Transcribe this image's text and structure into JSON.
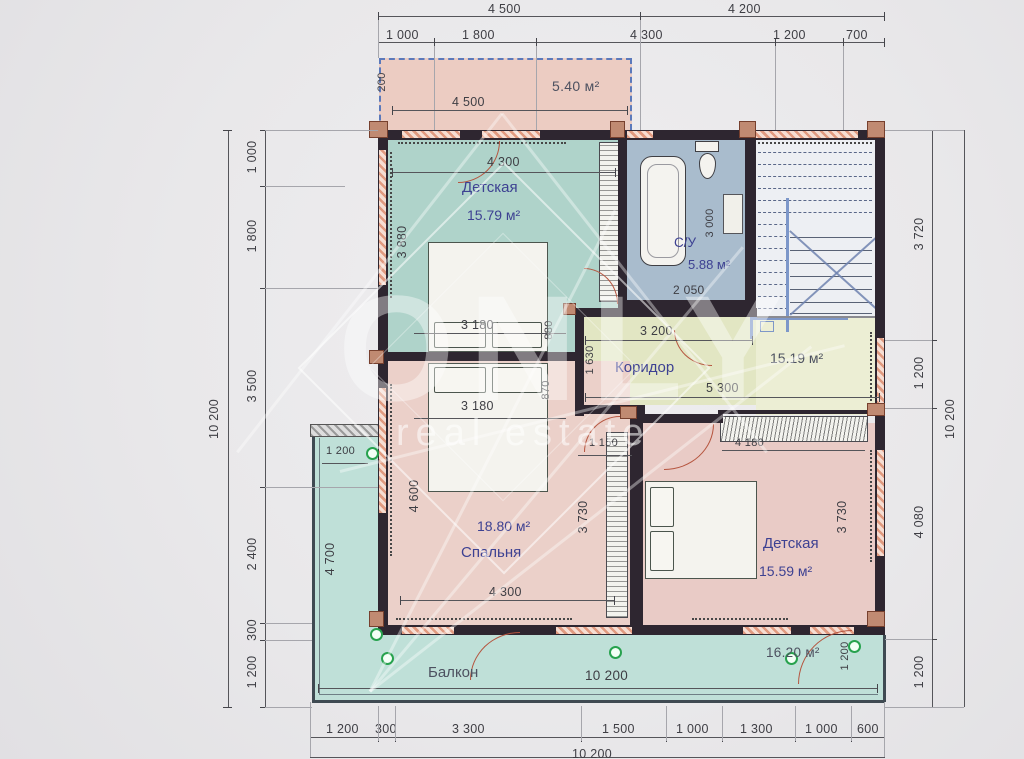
{
  "watermark": {
    "brand": "ONLY",
    "sub": "real estate"
  },
  "colors": {
    "room_teal": "#afd3ca",
    "room_pink": "#ebd0c9",
    "bath_blue": "#a9bccd",
    "corridor_green": "#e2e6c3",
    "hall_yellow": "#eceed4",
    "balcony_teal": "#bfe0d8",
    "balcony_top_pink": "#ecccc2",
    "wall": "#2e2630",
    "room_text": "#3d4192"
  },
  "dims": {
    "top1": [
      "4 500",
      "4 200"
    ],
    "top2": [
      "1 000",
      "1 800",
      "4 300",
      "1 200",
      "700"
    ],
    "left_total": "10 200",
    "left": [
      "1 000",
      "1 800",
      "3 500",
      "2 400",
      "300",
      "1 200"
    ],
    "right": [
      "3 720",
      "1 200",
      "4 080",
      "1 200"
    ],
    "right_total": "10 200",
    "bottom": [
      "1 200",
      "300",
      "3 300",
      "1 500",
      "1 000",
      "1 300",
      "1 000",
      "600"
    ],
    "bottom_total": "10 200"
  },
  "rooms": {
    "balcony_top": {
      "area": "5.40 м²",
      "width": "4 500",
      "depth": "200"
    },
    "nursery1": {
      "name": "Детская",
      "area": "15.79 м²",
      "width": "4 300",
      "height": "3 880",
      "bed_width": "3 180",
      "offset": "880"
    },
    "bath": {
      "name": "С/У",
      "area": "5.88 м²",
      "height": "3 000",
      "width": "2 050"
    },
    "corridor": {
      "name": "Коридор",
      "width_top": "3 200",
      "height": "1 630",
      "width_bottom": "5 300",
      "offset": "870",
      "passage": "1 150"
    },
    "hall": {
      "area": "15.19 м²"
    },
    "bedroom": {
      "name": "Спальня",
      "area": "18.80 м²",
      "bed_width": "3 180",
      "height_left": "4 600",
      "height_right": "3 730",
      "width_bottom": "4 300"
    },
    "nursery2": {
      "name": "Детская",
      "area": "15.59 м²",
      "height_right": "3 730",
      "wardrobe_width": "4 180"
    },
    "balcony_left": {
      "width_top": "1 200",
      "height": "4 700"
    },
    "balcony_bottom": {
      "name": "Балкон",
      "width": "10 200",
      "area": "16.20 м²",
      "depth_right": "1 200"
    }
  }
}
